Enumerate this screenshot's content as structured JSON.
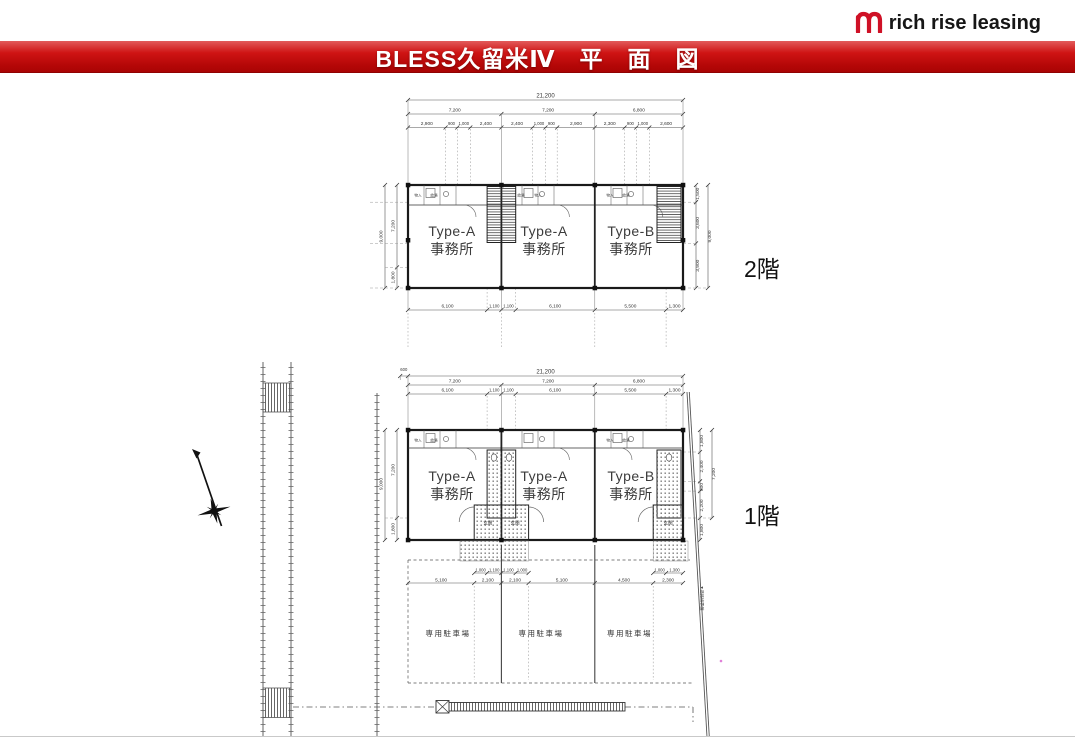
{
  "brand": {
    "logo_text": "rich rise leasing",
    "accent": "#cf1126"
  },
  "banner": {
    "title": "BLESS久留米Ⅳ　平　面　図"
  },
  "floor_labels": {
    "f2": "2階",
    "f1": "1階"
  },
  "unit_labels": {
    "names": [
      "Type-A",
      "Type-A",
      "Type-B"
    ],
    "suffix": "事務所"
  },
  "dims": {
    "total": "21,200",
    "spans": [
      "7,200",
      "7,200",
      "6,800"
    ],
    "f2_top": [
      "2,900",
      "900",
      "1,000",
      "2,400",
      "2,400",
      "1,000",
      "900",
      "2,900",
      "2,300",
      "900",
      "1,000",
      "2,600"
    ],
    "bays": [
      "6,100",
      "1,100",
      "1,100",
      "6,100",
      "5,500",
      "1,300"
    ],
    "h_total": "9,000",
    "h_upper": "7,200",
    "h_lower": "1,800",
    "f2_right": [
      "1,500",
      "3,600",
      "3,900"
    ],
    "f1_offset": "600",
    "f1_right": [
      "1,800",
      "2,400",
      "800",
      "2,200"
    ],
    "park": [
      "5,100",
      "2,100",
      "2,100",
      "5,100",
      "4,500",
      "2,300"
    ],
    "park_sub": [
      "1,000",
      "1,100",
      "1,100",
      "1,000",
      "1,000",
      "1,300"
    ]
  },
  "site_labels": {
    "parking": "専用駐車場",
    "entrance": "玄関",
    "boundary": "▼道路境界線",
    "fx_a": "物入",
    "fx_b": "給湯"
  }
}
